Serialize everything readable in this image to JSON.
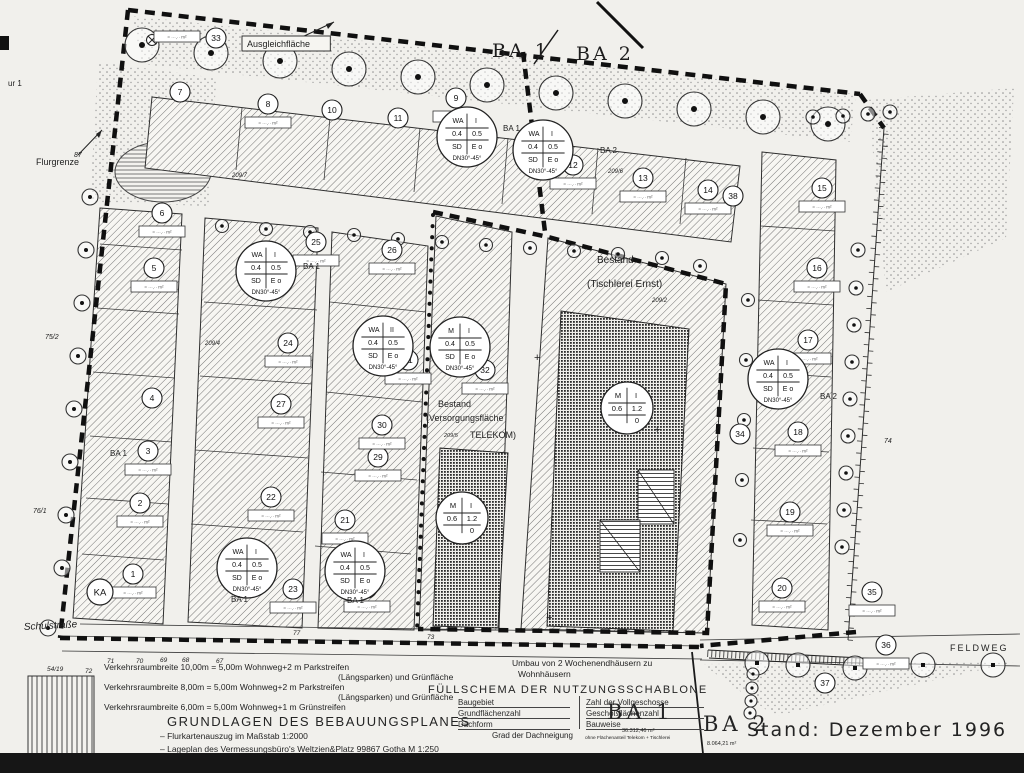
{
  "scan": {
    "paper": "#f1f0ec",
    "ink": "#1c1c1c",
    "hatch_line": "#6f6f6f",
    "dark_fill": "#2a2a2a"
  },
  "map_labels": [
    {
      "t": "Flurgrenze",
      "x": 36,
      "y": 165,
      "s": 9
    },
    {
      "t": "ur 1",
      "x": 8,
      "y": 86,
      "s": 8
    },
    {
      "t": "Ausgleichfläche",
      "x": 247,
      "y": 47,
      "s": 9,
      "box": 1
    },
    {
      "t": "BA 1",
      "x": 492,
      "y": 57,
      "s": 19,
      "f": "serif",
      "sp": 3
    },
    {
      "t": "BA 2",
      "x": 576,
      "y": 60,
      "s": 19,
      "f": "serif",
      "sp": 3
    },
    {
      "t": "Bestand",
      "x": 597,
      "y": 263,
      "s": 10
    },
    {
      "t": "(Tischlerei  Ernst)",
      "x": 587,
      "y": 287,
      "s": 10
    },
    {
      "t": "Bestand",
      "x": 438,
      "y": 407,
      "s": 9
    },
    {
      "t": "(Versorgungsfläche",
      "x": 426,
      "y": 421,
      "s": 9
    },
    {
      "t": "TELEKOM)",
      "x": 470,
      "y": 438,
      "s": 9
    },
    {
      "t": "209/5",
      "x": 444,
      "y": 437,
      "s": 5.5,
      "it": 1
    },
    {
      "t": "Schulstraße",
      "x": 24,
      "y": 630,
      "s": 10,
      "it": 1,
      "rot": -3
    },
    {
      "t": "FELDWEG",
      "x": 950,
      "y": 651,
      "s": 9,
      "sp": 2
    },
    {
      "t": "BA 1",
      "x": 503,
      "y": 131,
      "s": 8
    },
    {
      "t": "BA 2",
      "x": 600,
      "y": 153,
      "s": 8
    },
    {
      "t": "BA 1",
      "x": 303,
      "y": 269,
      "s": 8
    },
    {
      "t": "BA 1",
      "x": 110,
      "y": 456,
      "s": 8
    },
    {
      "t": "BA 2",
      "x": 820,
      "y": 399,
      "s": 8
    },
    {
      "t": "BA 1",
      "x": 231,
      "y": 602,
      "s": 8
    },
    {
      "t": "BA 1",
      "x": 347,
      "y": 603,
      "s": 8
    },
    {
      "t": "209/7",
      "x": 232,
      "y": 177,
      "s": 6,
      "it": 1
    },
    {
      "t": "209/6",
      "x": 608,
      "y": 173,
      "s": 6,
      "it": 1
    },
    {
      "t": "209/2",
      "x": 652,
      "y": 302,
      "s": 6,
      "it": 1
    },
    {
      "t": "209/4",
      "x": 205,
      "y": 345,
      "s": 6,
      "it": 1
    },
    {
      "t": "87",
      "x": 74,
      "y": 157,
      "s": 7,
      "it": 1
    },
    {
      "t": "75/2",
      "x": 45,
      "y": 339,
      "s": 7,
      "it": 1
    },
    {
      "t": "76/1",
      "x": 33,
      "y": 513,
      "s": 7,
      "it": 1
    },
    {
      "t": "74",
      "x": 884,
      "y": 443,
      "s": 7,
      "it": 1
    },
    {
      "t": "54/19",
      "x": 47,
      "y": 671,
      "s": 6.5,
      "it": 1
    },
    {
      "t": "72",
      "x": 85,
      "y": 673,
      "s": 6.5,
      "it": 1
    },
    {
      "t": "71",
      "x": 107,
      "y": 663,
      "s": 6.5,
      "it": 1
    },
    {
      "t": "70",
      "x": 136,
      "y": 663,
      "s": 6.5,
      "it": 1
    },
    {
      "t": "69",
      "x": 160,
      "y": 662,
      "s": 6.5,
      "it": 1
    },
    {
      "t": "68",
      "x": 182,
      "y": 662,
      "s": 6.5,
      "it": 1
    },
    {
      "t": "67",
      "x": 216,
      "y": 663,
      "s": 6.5,
      "it": 1
    },
    {
      "t": "77",
      "x": 293,
      "y": 635,
      "s": 6.5,
      "it": 1
    },
    {
      "t": "73",
      "x": 427,
      "y": 639,
      "s": 6.5,
      "it": 1
    },
    {
      "t": "+",
      "x": 534,
      "y": 361,
      "s": 11
    },
    {
      "t": "+",
      "x": 654,
      "y": 433,
      "s": 11
    },
    {
      "t": "+",
      "x": 546,
      "y": 621,
      "s": 11
    }
  ],
  "plots": [
    {
      "n": "1",
      "x": 133,
      "y": 574,
      "d": 1
    },
    {
      "n": "2",
      "x": 140,
      "y": 503,
      "d": 1
    },
    {
      "n": "3",
      "x": 148,
      "y": 451,
      "d": 1
    },
    {
      "n": "4",
      "x": 152,
      "y": 398,
      "d": 0
    },
    {
      "n": "5",
      "x": 154,
      "y": 268,
      "d": 1
    },
    {
      "n": "6",
      "x": 162,
      "y": 213,
      "d": 1
    },
    {
      "n": "7",
      "x": 180,
      "y": 92,
      "d": 0
    },
    {
      "n": "8",
      "x": 268,
      "y": 104,
      "d": 1
    },
    {
      "n": "9",
      "x": 456,
      "y": 98,
      "d": 1
    },
    {
      "n": "10",
      "x": 332,
      "y": 110,
      "d": 0
    },
    {
      "n": "11",
      "x": 398,
      "y": 118,
      "d": 0
    },
    {
      "n": "12",
      "x": 573,
      "y": 165,
      "d": 1
    },
    {
      "n": "13",
      "x": 643,
      "y": 178,
      "d": 1
    },
    {
      "n": "14",
      "x": 708,
      "y": 190,
      "d": 1
    },
    {
      "n": "15",
      "x": 822,
      "y": 188,
      "d": 1
    },
    {
      "n": "16",
      "x": 817,
      "y": 268,
      "d": 1
    },
    {
      "n": "17",
      "x": 808,
      "y": 340,
      "d": 1
    },
    {
      "n": "18",
      "x": 798,
      "y": 432,
      "d": 1
    },
    {
      "n": "19",
      "x": 790,
      "y": 512,
      "d": 1
    },
    {
      "n": "20",
      "x": 782,
      "y": 588,
      "d": 1
    },
    {
      "n": "21",
      "x": 345,
      "y": 520,
      "d": 1
    },
    {
      "n": "22",
      "x": 271,
      "y": 497,
      "d": 1
    },
    {
      "n": "23",
      "x": 293,
      "y": 589,
      "d": 1
    },
    {
      "n": "24",
      "x": 288,
      "y": 343,
      "d": 1
    },
    {
      "n": "25",
      "x": 316,
      "y": 242,
      "d": 1
    },
    {
      "n": "26",
      "x": 392,
      "y": 250,
      "d": 1
    },
    {
      "n": "27",
      "x": 281,
      "y": 404,
      "d": 1
    },
    {
      "n": "28",
      "x": 367,
      "y": 588,
      "d": 1
    },
    {
      "n": "29",
      "x": 378,
      "y": 457,
      "d": 1
    },
    {
      "n": "30",
      "x": 382,
      "y": 425,
      "d": 1
    },
    {
      "n": "31",
      "x": 408,
      "y": 360,
      "d": 1
    },
    {
      "n": "32",
      "x": 485,
      "y": 370,
      "d": 1
    },
    {
      "n": "33",
      "x": 216,
      "y": 38,
      "d": 1,
      "dx": -62,
      "dy": -7
    },
    {
      "n": "34",
      "x": 740,
      "y": 434,
      "d": 0
    },
    {
      "n": "35",
      "x": 872,
      "y": 592,
      "d": 1
    },
    {
      "n": "36",
      "x": 886,
      "y": 645,
      "d": 1
    },
    {
      "n": "37",
      "x": 825,
      "y": 683,
      "d": 0
    },
    {
      "n": "38",
      "x": 733,
      "y": 196,
      "d": 0
    }
  ],
  "special_marker": {
    "label": "KA",
    "x": 100,
    "y": 592
  },
  "dim_box_text": "≈ ···,·· m²",
  "schablonen": [
    {
      "x": 467,
      "y": 137,
      "a": "WA",
      "b": "I",
      "c": "0.4",
      "d": "0.5",
      "e": "SD",
      "f": "E o",
      "foot": "DN30°-45°",
      "big": 0
    },
    {
      "x": 543,
      "y": 150,
      "a": "WA",
      "b": "I",
      "c": "0.4",
      "d": "0.5",
      "e": "SD",
      "f": "E o",
      "foot": "DN30°-45°",
      "big": 0
    },
    {
      "x": 266,
      "y": 271,
      "a": "WA",
      "b": "I",
      "c": "0.4",
      "d": "0.5",
      "e": "SD",
      "f": "E o",
      "foot": "DN30°-45°",
      "big": 0
    },
    {
      "x": 383,
      "y": 346,
      "a": "WA",
      "b": "II",
      "c": "0.4",
      "d": "0.5",
      "e": "SD",
      "f": "E o",
      "foot": "DN30°-45°",
      "big": 0
    },
    {
      "x": 460,
      "y": 347,
      "a": "M",
      "b": "I",
      "c": "0.4",
      "d": "0.5",
      "e": "SD",
      "f": "E o",
      "foot": "DN30°-45°",
      "big": 0
    },
    {
      "x": 778,
      "y": 379,
      "a": "WA",
      "b": "I",
      "c": "0.4",
      "d": "0.5",
      "e": "SD",
      "f": "E o",
      "foot": "DN30°-45°",
      "big": 0
    },
    {
      "x": 247,
      "y": 568,
      "a": "WA",
      "b": "I",
      "c": "0.4",
      "d": "0.5",
      "e": "SD",
      "f": "E o",
      "foot": "DN30°-45°",
      "big": 0
    },
    {
      "x": 355,
      "y": 571,
      "a": "WA",
      "b": "I",
      "c": "0.4",
      "d": "0.5",
      "e": "SD",
      "f": "E o",
      "foot": "DN30°-45°",
      "big": 0
    },
    {
      "x": 627,
      "y": 408,
      "a": "M",
      "b": "I",
      "c": "0.6",
      "d": "1.2",
      "e": "",
      "f": "0",
      "foot": "",
      "big": 1
    },
    {
      "x": 462,
      "y": 518,
      "a": "M",
      "b": "I",
      "c": "0.6",
      "d": "1.2",
      "e": "",
      "f": "0",
      "foot": "",
      "big": 1
    }
  ],
  "legend": {
    "v1": "Verkehrsraumbreite  10,00m  =  5,00m Wohnweg+2 m Parkstreifen",
    "v1b": "(Längsparken) und Grünfläche",
    "v2": "Verkehrsraumbreite    8,00m  =  5,00m Wohnweg+2 m Parkstreifen",
    "v2b": "(Längsparken) und Grünfläche",
    "v3": "Verkehrsraumbreite    6,00m  =  5,00m Wohnweg+1 m Grünstreifen",
    "title": "GRUNDLAGEN DES BEBAUUNGSPLANES",
    "b1": "–  Flurkartenauszug im Maßstab 1:2000",
    "b2": "–  Lageplan des Vermessungsbüro's Weltzien&Platz 99867 Gotha M 1:250"
  },
  "fuellschema": {
    "note1": "Umbau von 2 Wochenendhäusern zu",
    "note2": "Wohnhäusern",
    "title": "FÜLLSCHEMA DER NUTZUNGSSCHABLONE",
    "r1l": "Baugebiet",
    "r1r": "Zahl der Vollgeschosse",
    "r2l": "Grundflächenzahl",
    "r2r": "Geschoßflächenzahl",
    "r3l": "Dachform",
    "r3r": "Bauweise",
    "footer": "Grad der Dachneigung"
  },
  "summary": {
    "ba1": "BA 1",
    "ba1_area": "36.312,46 m²",
    "ba1_note": "ohne Flächenanteil Telekom + Tischlerei",
    "ba2": "BA 2",
    "ba2_area": "8.064,21 m²",
    "stand": "Stand:  Dezember  1996"
  }
}
